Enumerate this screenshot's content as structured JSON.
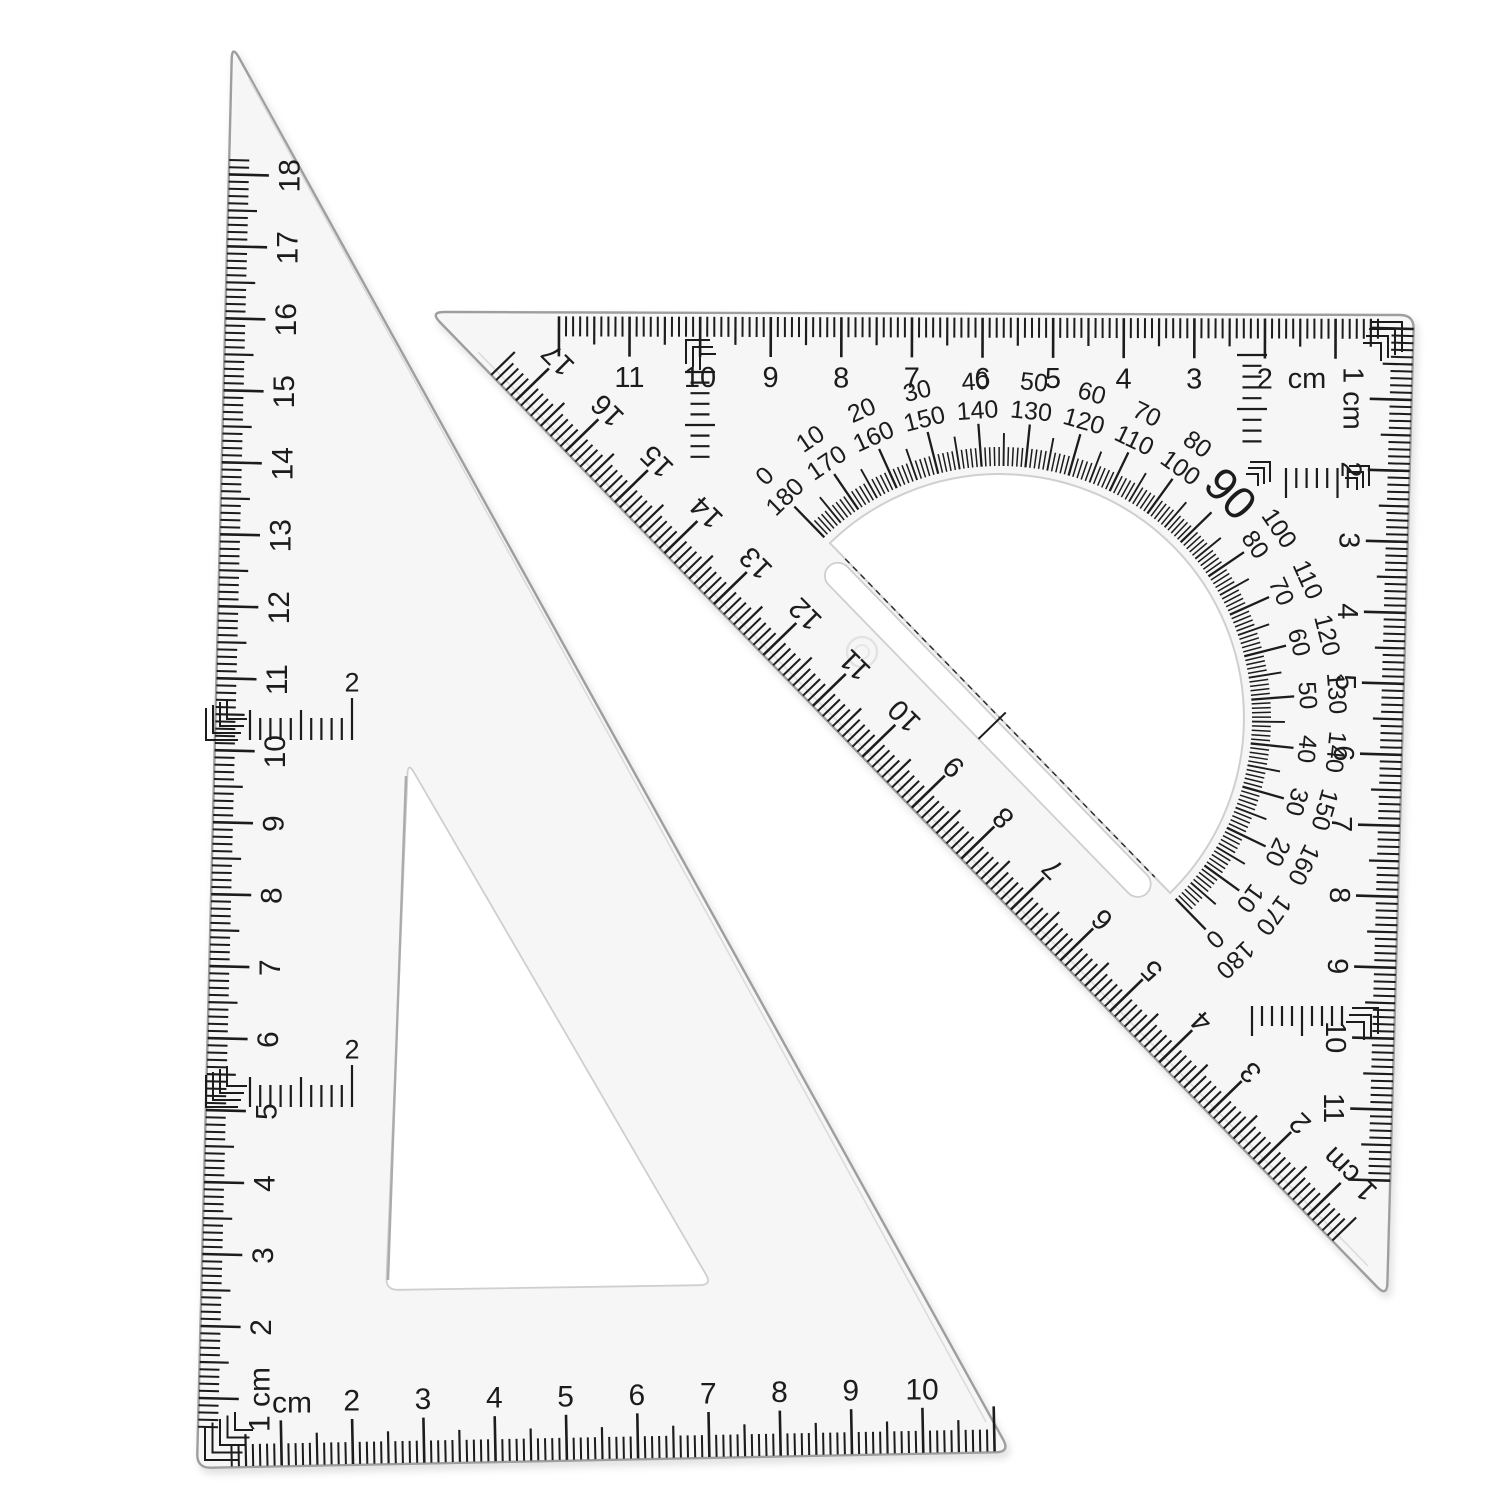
{
  "scene_label": "two transparent triangular set squares with rulers and protractor",
  "colors": {
    "background": "#ffffff",
    "ink": "#1c1c1c",
    "plastic_edge": "#9e9e9e",
    "plastic_fill": "#f7f7f7",
    "faint_edge": "#cfcfcf"
  },
  "left_triangle": {
    "left_ruler": {
      "unit_label": "1 cm",
      "numbers": [
        "2",
        "3",
        "4",
        "5",
        "6",
        "7",
        "8",
        "9",
        "10",
        "11",
        "12",
        "13",
        "14",
        "15",
        "16",
        "17",
        "18"
      ]
    },
    "bottom_ruler": {
      "unit_label": "cm",
      "numbers": [
        "2",
        "3",
        "4",
        "5",
        "6",
        "7",
        "8",
        "9",
        "10"
      ]
    },
    "inner_scale_upper": {
      "label": "2"
    },
    "inner_scale_lower": {
      "label": "2"
    }
  },
  "right_triangle": {
    "top_ruler": {
      "numbers": [
        "11",
        "10",
        "9",
        "8",
        "7",
        "6",
        "5",
        "4",
        "3",
        "2"
      ],
      "unit_label": "cm"
    },
    "right_ruler": {
      "unit_label": "1 cm",
      "numbers": [
        "2",
        "3",
        "4",
        "5",
        "6",
        "7",
        "8",
        "9",
        "10",
        "11"
      ]
    },
    "hypotenuse_ruler": {
      "numbers": [
        "17",
        "16",
        "15",
        "14",
        "13",
        "12",
        "11",
        "10",
        "9",
        "8",
        "7",
        "6",
        "5",
        "4",
        "3",
        "2"
      ],
      "unit_label": "1 cm"
    },
    "protractor": {
      "outer_degrees": [
        "0",
        "10",
        "20",
        "30",
        "40",
        "50",
        "60",
        "70",
        "80",
        "90",
        "100",
        "110",
        "120",
        "130",
        "140",
        "150",
        "160",
        "170",
        "180"
      ],
      "inner_degrees": [
        "180",
        "170",
        "160",
        "150",
        "140",
        "130",
        "120",
        "110",
        "100",
        "90",
        "80",
        "70",
        "60",
        "50",
        "40",
        "30",
        "20",
        "10",
        "0"
      ],
      "right_angle_label": "90"
    }
  }
}
